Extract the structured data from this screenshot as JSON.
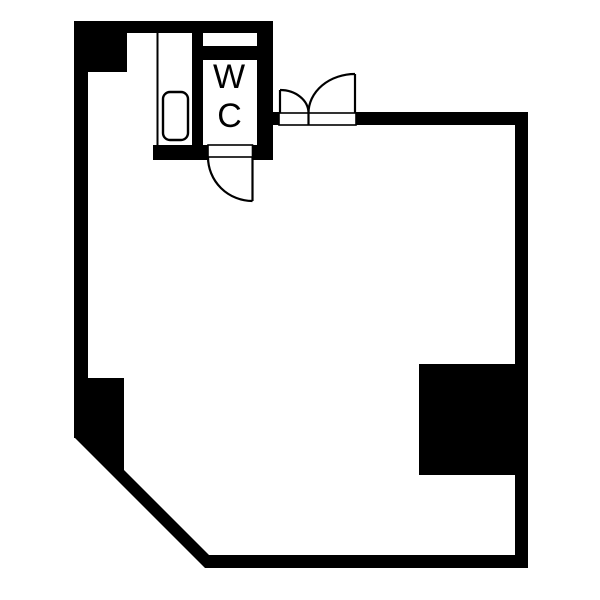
{
  "canvas": {
    "background_color": "#ffffff"
  },
  "floor_plan": {
    "wall_color": "#000000",
    "line_color": "#000000",
    "rooms": [
      {
        "id": "wc",
        "label_line1": "W",
        "label_line2": "C"
      }
    ],
    "doors": [
      {
        "id": "wc-door",
        "type": "single-swing"
      },
      {
        "id": "entry-door",
        "type": "double-swing-unequal-leaves"
      }
    ],
    "fixtures": [
      {
        "id": "washer-pan",
        "shape": "rounded-rect"
      }
    ]
  }
}
